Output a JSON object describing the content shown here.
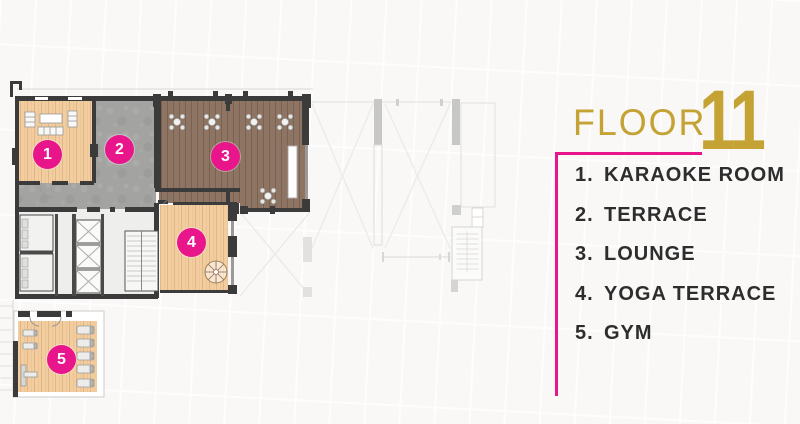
{
  "title": {
    "floor_label": "FLOOR",
    "floor_number": "11"
  },
  "legend": {
    "items": [
      {
        "num": "1.",
        "label": "KARAOKE ROOM"
      },
      {
        "num": "2.",
        "label": "TERRACE"
      },
      {
        "num": "3.",
        "label": "LOUNGE"
      },
      {
        "num": "4.",
        "label": "YOGA TERRACE"
      },
      {
        "num": "5.",
        "label": "GYM"
      }
    ]
  },
  "plan": {
    "badges": [
      {
        "number": "1"
      },
      {
        "number": "2"
      },
      {
        "number": "3"
      },
      {
        "number": "4"
      },
      {
        "number": "5"
      }
    ]
  },
  "colors": {
    "accent_pink": "#E9158A",
    "accent_gold": "#C4A233",
    "wall": "#3B3B3B",
    "wood_light": "#F2CDA0",
    "wood_dark": "#8E7463",
    "terrace_concrete": "#A3A3A1",
    "text": "#2D2D2D"
  }
}
